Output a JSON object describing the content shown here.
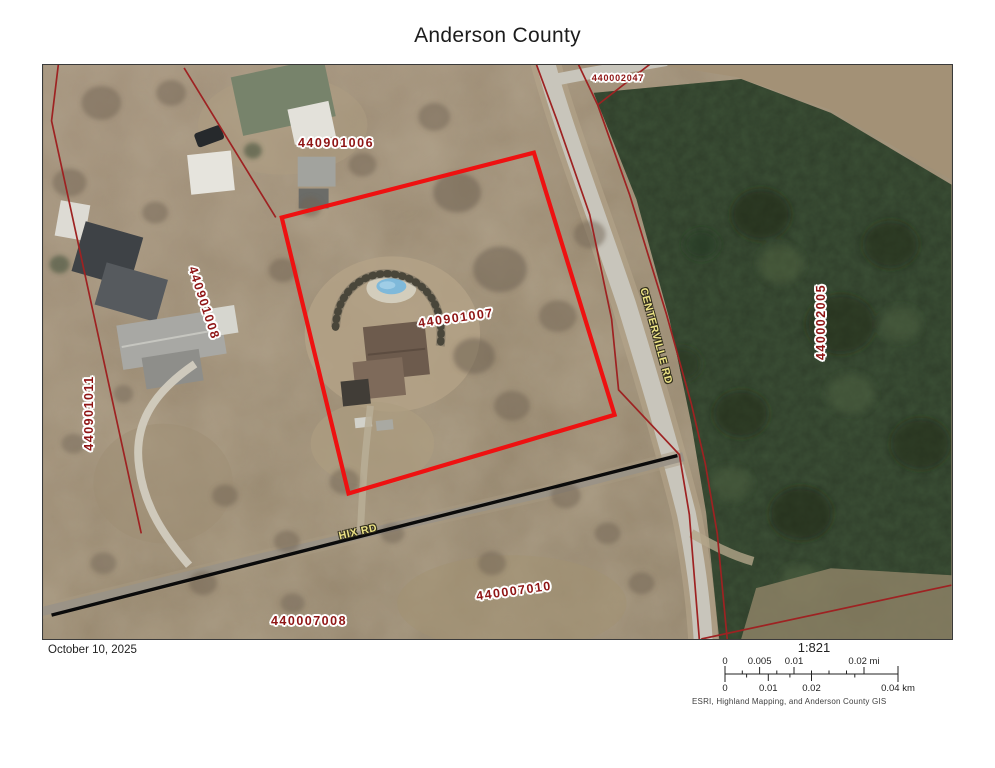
{
  "title": "Anderson County",
  "map": {
    "parcel_labels": [
      {
        "text": "440901006"
      },
      {
        "text": "440002047"
      },
      {
        "text": "440901008"
      },
      {
        "text": "440901011"
      },
      {
        "text": "440901007"
      },
      {
        "text": "440002005"
      },
      {
        "text": "440007010"
      },
      {
        "text": "440007008"
      }
    ],
    "road_labels": [
      {
        "text": "CENTERVILLE RD"
      },
      {
        "text": "HIX RD"
      }
    ],
    "colors": {
      "highlighted_parcel": "#ee1111",
      "parcel_line": "#9e2222",
      "parcel_label": "#8f1515",
      "road_label": "#ece284"
    }
  },
  "footer": {
    "date": "October 10, 2025",
    "scale_ratio": "1:821",
    "scale_mi": {
      "labels": [
        "0",
        "0.005",
        "0.01",
        "0.02 mi"
      ]
    },
    "scale_km": {
      "labels": [
        "0",
        "0.01",
        "0.02",
        "0.04 km"
      ]
    },
    "attribution": "ESRI, Highland Mapping, and Anderson County GIS"
  }
}
